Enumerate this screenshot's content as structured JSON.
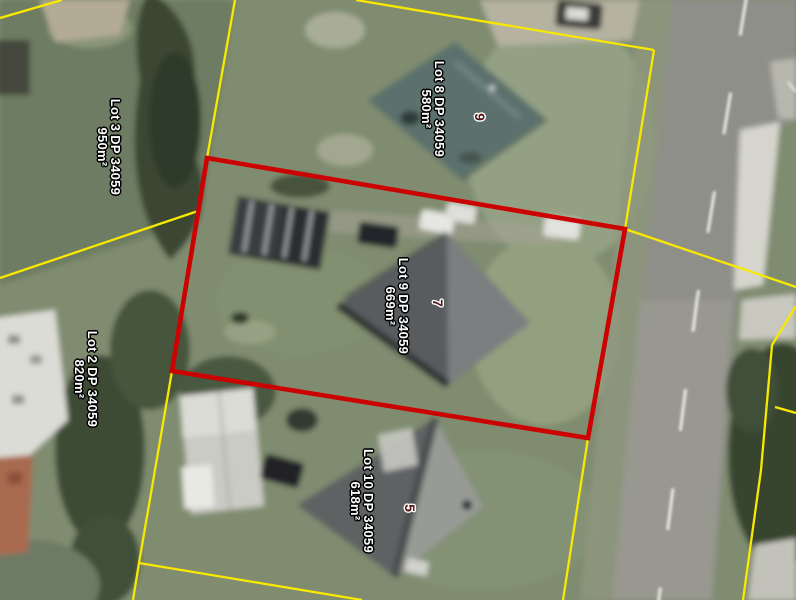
{
  "parcels": {
    "lot3": {
      "title": "Lot 3 DP 34059",
      "area": "950m²"
    },
    "lot8": {
      "title": "Lot 8 DP 34059",
      "area": "580m²"
    },
    "lot9": {
      "title": "Lot 9 DP 34059",
      "area": "669m²"
    },
    "lot2": {
      "title": "Lot 2 DP 34059",
      "area": "820m²"
    },
    "lot10": {
      "title": "Lot 10 DP 34059",
      "area": "618m²"
    }
  },
  "house_numbers": {
    "lot8": "9",
    "lot9": "7",
    "lot10": "5"
  },
  "highlight": {
    "parcel_title": "Lot 9 DP 34059",
    "boundary_color": "#cc0202"
  },
  "colors": {
    "parcel_boundary": "#f9e800",
    "highlighted_parcel_boundary": "#cc0202",
    "parcel_label_text": "#ffffff",
    "house_number_text": "#531414"
  }
}
